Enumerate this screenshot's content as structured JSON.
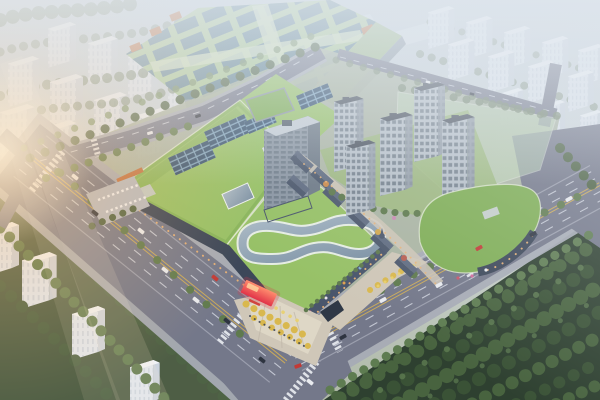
{
  "scene": {
    "title": "Aerial rendering of a mixed-use retail complex at dusk",
    "type": "aerial architectural rendering (bird's-eye perspective)",
    "lighting": "hazy dusk atmosphere with warm sun flare entering from the left edge",
    "regions": [
      {
        "name": "background-city-left",
        "description": "rows of hazy grey apartment slabs fading into mist, upper left"
      },
      {
        "name": "background-city-right",
        "description": "diagonal rows of pale residential slabs among trees, upper right"
      },
      {
        "name": "expo-hall",
        "description": "large pale-green-roofed exhibition hall with banded skylights and orange trim blocks, top centre"
      },
      {
        "name": "shopping-mall",
        "description": "retail podium with planted green roofs, rooftop photovoltaic arrays and a looping glass atrium skylight"
      },
      {
        "name": "office-tower",
        "description": "mid-rise grey slab tower rising from the mall podium"
      },
      {
        "name": "residential-towers",
        "description": "cluster of five grey high-rise towers on a landscaped courtyard"
      },
      {
        "name": "retail-street",
        "description": "low-rise European-style shopping lane with slate pitched roofs and turrets"
      },
      {
        "name": "east-pavilion",
        "description": "curved corner retail pavilion with green roof and dark storefront facade"
      },
      {
        "name": "future-phase-overlay",
        "description": "translucent pale-green massing of an unbuilt phase, upper right of site"
      },
      {
        "name": "main-boulevard",
        "description": "multi-lane avenue with dashed lane lines running past the south-west frontage"
      },
      {
        "name": "east-avenue",
        "description": "tree-lined avenue along the south-east frontage"
      },
      {
        "name": "south-plaza",
        "description": "entrance plaza with golden trees, radiating paving and pedestrians"
      },
      {
        "name": "led-screen",
        "description": "bright red/orange LED media screen on the mall's south corner"
      },
      {
        "name": "forest-park",
        "description": "dense dark-green woodland filling the lower-right corner"
      },
      {
        "name": "sun-flare",
        "description": "warm glare and light rays from the left edge"
      }
    ],
    "traffic": {
      "approx_vehicle_count": 20,
      "vehicle_colors": [
        "white",
        "dark grey",
        "red"
      ]
    }
  },
  "palette": {
    "sky_top": "#c3cdd7",
    "sky_mid": "#d2dadb",
    "ground": "#aeb8a6",
    "haze": "#e2e9f0",
    "sun_glow": "#ffc37d",
    "sun_core": "#ffeccd",
    "road": "#74788a",
    "road_line": "#d6dae3",
    "road_yellow": "#d2ae55",
    "sidewalk": "#a6abb5",
    "plaza": "#cfc7b8",
    "plaza_light": "#e3dccb",
    "green_roof": "#97c167",
    "green_roof_dark": "#7fae55",
    "lawn": "#9cb87c",
    "expo_roof": "#a9c790",
    "expo_skylight": "#567992",
    "solar_panel": "#33506e",
    "solar_frame": "#7da3bf",
    "orange_accent": "#c17344",
    "facade_dark": "#3c4759",
    "facade_mid": "#4a566c",
    "storefront_warm": "#e9b277",
    "led_red": "#e13348",
    "led_hot": "#ff8d6e",
    "glass": "#a9b9c6",
    "glass_deep": "#7b90a3",
    "glass_rim": "#eef2f2",
    "tower_front": "#b7c0c9",
    "tower_side": "#96a0ab",
    "tower_window": "#65727f",
    "tower_roof": "#4a525e",
    "office_front": "#8b96a3",
    "office_side": "#6e7a87",
    "office_top": "#c4ccd4",
    "bg_front": "#e1e7ef",
    "bg_side": "#cbd3de",
    "bg_top": "#f0f3f7",
    "bg_stripe": "#bcc7d4",
    "tree_dark": "#4e6345",
    "tree_mid": "#5f7a4e",
    "tree_light": "#728c5c",
    "tree_bg": "#72836a",
    "tree_olive": "#68784f",
    "tree_yellow": "#d9b84e",
    "tree_gold": "#e9d06c",
    "forest": "#2e4030",
    "forest_tree": "#48633f",
    "forest_tree_dark": "#3a5236",
    "forest_highlight": "#5e7c51",
    "retail_roof": "#4d596d",
    "retail_roof_lit": "#616d82",
    "retail_wall": "#9b6a56",
    "wedge": "#c2dcba",
    "car_white": "#e9ebef",
    "car_dark": "#2e3440",
    "car_red": "#c23a36"
  }
}
